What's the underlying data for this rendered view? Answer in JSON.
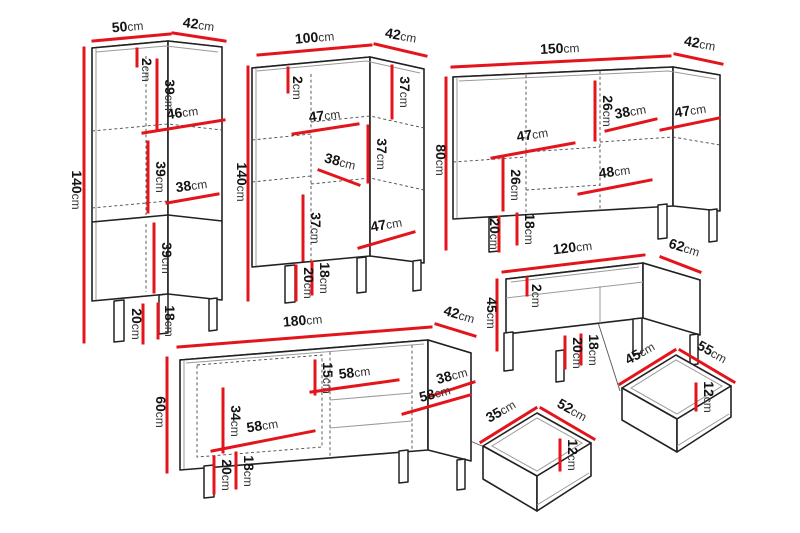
{
  "units": {
    "cm": "cm"
  },
  "colors": {
    "dimension_red": "#e4141c",
    "outline_black": "#222222",
    "background": "#ffffff"
  },
  "furniture": {
    "tall_cabinet": {
      "width": "50",
      "depth": "42",
      "height": "140",
      "top_thickness": "2",
      "upper_section": "39",
      "upper_shelf": "46",
      "middle_section": "39",
      "lower_shelf": "38",
      "lower_section": "39",
      "floor_clearance": "18",
      "leg_height": "20"
    },
    "wide_cabinet": {
      "width": "100",
      "depth": "42",
      "height": "140",
      "top_thickness": "2",
      "upper_left_shelf": "47",
      "upper_right_section": "37",
      "middle_left_shelf": "38",
      "middle_right_section": "37",
      "lower_left_section": "37",
      "lower_right_shelf": "47",
      "floor_clearance": "18",
      "leg_height": "20"
    },
    "sideboard": {
      "width": "150",
      "depth": "42",
      "height": "80",
      "top_middle_section": "26",
      "middle_shelf": "38",
      "right_shelf": "47",
      "left_shelf": "47",
      "left_middle_section": "26",
      "bottom_middle_shelf": "48",
      "floor_clearance": "18",
      "leg_height": "20"
    },
    "coffee_table": {
      "width": "120",
      "depth": "62",
      "height": "45",
      "top_thickness": "2",
      "floor_clearance": "18",
      "leg_height": "20"
    },
    "tv_stand": {
      "width": "180",
      "depth": "42",
      "height": "60",
      "shelf_opening": "15",
      "middle_shelf": "58",
      "right_shelf_depth": "38",
      "right_shelf": "58",
      "left_door_section": "34",
      "left_shelf": "58",
      "floor_clearance": "18",
      "leg_height": "20"
    },
    "small_drawer": {
      "width": "35",
      "depth": "52",
      "height": "12"
    },
    "large_drawer": {
      "width": "45",
      "depth": "55",
      "height": "12"
    }
  }
}
